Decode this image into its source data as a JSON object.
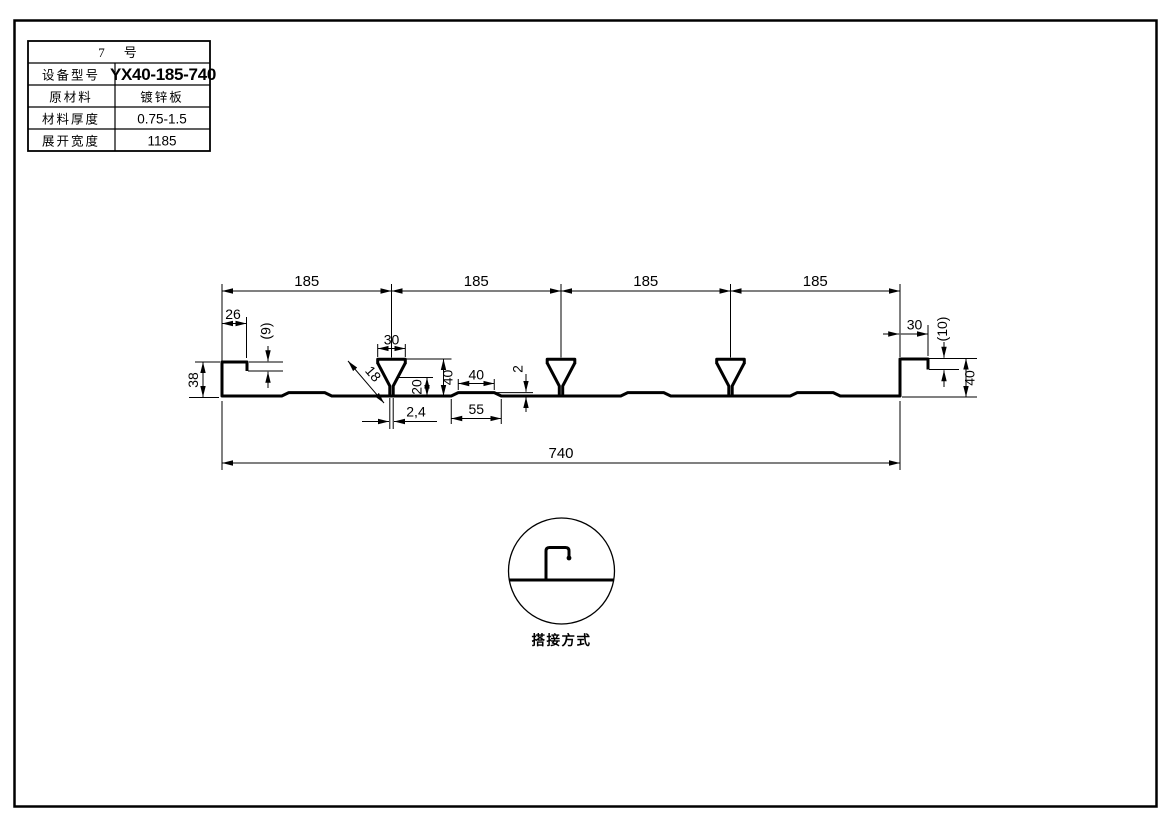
{
  "colors": {
    "line": "#000000",
    "background": "#ffffff"
  },
  "spec_table": {
    "header": "7　号",
    "rows": [
      {
        "label": "设备型号",
        "value": "YX40-185-740"
      },
      {
        "label": "原材料",
        "value": "镀锌板"
      },
      {
        "label": "材料厚度",
        "value": "0.75-1.5"
      },
      {
        "label": "展开宽度",
        "value": "1185"
      }
    ]
  },
  "profile_drawing": {
    "pitch_labels": [
      "185",
      "185",
      "185",
      "185"
    ],
    "total_width": "740",
    "left_edge": {
      "flange_width": "26",
      "hook_depth": "(9)",
      "height": "38"
    },
    "rib": {
      "top_width": "30",
      "leg_length": "18",
      "stem_gap": "2,4",
      "height": "40",
      "mid_height": "20"
    },
    "stiffener": {
      "top_width": "40",
      "base_width": "55",
      "height": "2"
    },
    "right_edge": {
      "flange_width": "30",
      "hook_depth": "(10)",
      "height": "40"
    }
  },
  "lap_detail": {
    "caption": "搭接方式"
  }
}
